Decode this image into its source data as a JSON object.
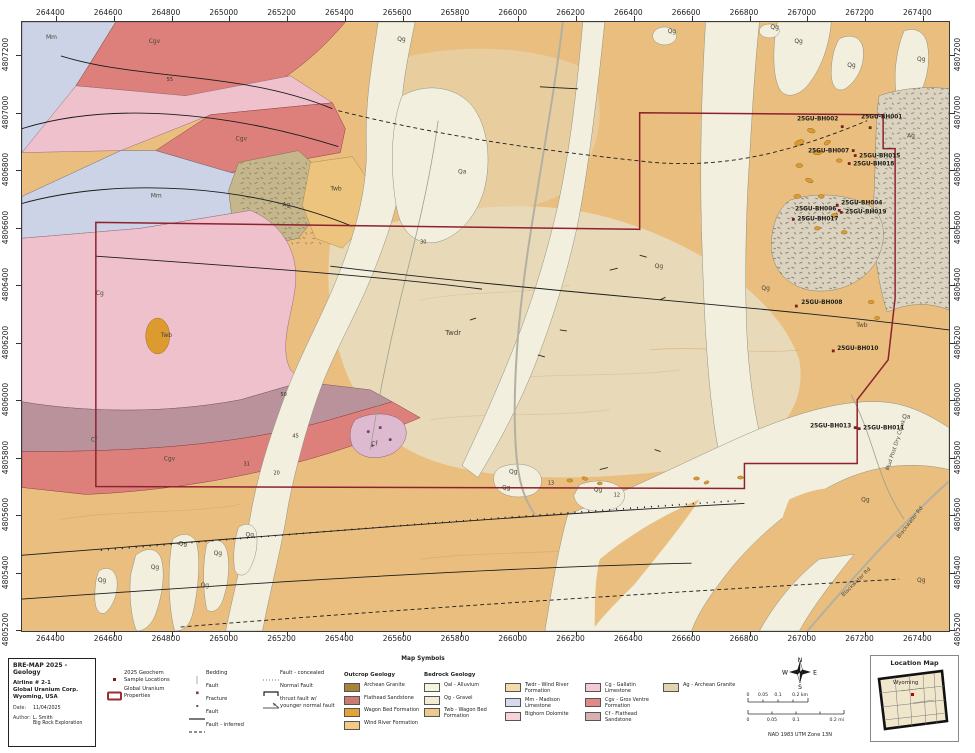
{
  "map": {
    "x_coords": [
      "264400",
      "264600",
      "264800",
      "265000",
      "265200",
      "265400",
      "265600",
      "265800",
      "266000",
      "266200",
      "266400",
      "266600",
      "266800",
      "267000",
      "267200",
      "267400"
    ],
    "y_coords": [
      "4807200",
      "4807000",
      "4806800",
      "4806600",
      "4806400",
      "4806200",
      "4806000",
      "4805800",
      "4805600",
      "4805400",
      "4805200"
    ],
    "unit_labels": [
      {
        "t": "Mm",
        "x": 45,
        "y": 38
      },
      {
        "t": "Cgv",
        "x": 148,
        "y": 42
      },
      {
        "t": "Cgv",
        "x": 235,
        "y": 140
      },
      {
        "t": "Mm",
        "x": 150,
        "y": 197
      },
      {
        "t": "Ag",
        "x": 282,
        "y": 206
      },
      {
        "t": "Twb",
        "x": 330,
        "y": 190
      },
      {
        "t": "Qa",
        "x": 458,
        "y": 173
      },
      {
        "t": "Qg",
        "x": 397,
        "y": 40
      },
      {
        "t": "Qg",
        "x": 668,
        "y": 32
      },
      {
        "t": "Qg",
        "x": 771,
        "y": 28
      },
      {
        "t": "Qg",
        "x": 795,
        "y": 42
      },
      {
        "t": "Qg",
        "x": 848,
        "y": 66
      },
      {
        "t": "Qg",
        "x": 918,
        "y": 60
      },
      {
        "t": "Ag",
        "x": 908,
        "y": 137
      },
      {
        "t": "Cg",
        "x": 95,
        "y": 295
      },
      {
        "t": "Twb",
        "x": 160,
        "y": 337
      },
      {
        "t": "Cf",
        "x": 90,
        "y": 442
      },
      {
        "t": "Cgv",
        "x": 163,
        "y": 461
      },
      {
        "t": "Twdr",
        "x": 445,
        "y": 335
      },
      {
        "t": "Cf",
        "x": 371,
        "y": 446
      },
      {
        "t": "Twb",
        "x": 857,
        "y": 327
      },
      {
        "t": "Qa",
        "x": 903,
        "y": 419
      },
      {
        "t": "Qg",
        "x": 655,
        "y": 268
      },
      {
        "t": "Qg",
        "x": 762,
        "y": 290
      },
      {
        "t": "Qg",
        "x": 509,
        "y": 474
      },
      {
        "t": "Qg",
        "x": 502,
        "y": 490
      },
      {
        "t": "Qg",
        "x": 594,
        "y": 492
      },
      {
        "t": "Qg",
        "x": 862,
        "y": 502
      },
      {
        "t": "Qg",
        "x": 918,
        "y": 583
      },
      {
        "t": "Qg",
        "x": 178,
        "y": 546
      },
      {
        "t": "Qg",
        "x": 213,
        "y": 556
      },
      {
        "t": "Qg",
        "x": 150,
        "y": 570
      },
      {
        "t": "Qg",
        "x": 200,
        "y": 588
      },
      {
        "t": "Qg",
        "x": 245,
        "y": 537
      },
      {
        "t": "Qg",
        "x": 97,
        "y": 583
      }
    ],
    "dip_labels": [
      {
        "t": "55",
        "x": 166,
        "y": 80
      },
      {
        "t": "30",
        "x": 420,
        "y": 243
      },
      {
        "t": "50",
        "x": 280,
        "y": 396
      },
      {
        "t": "45",
        "x": 292,
        "y": 438
      },
      {
        "t": "31",
        "x": 243,
        "y": 466
      },
      {
        "t": "20",
        "x": 273,
        "y": 475
      },
      {
        "t": "13",
        "x": 548,
        "y": 485
      },
      {
        "t": "12",
        "x": 614,
        "y": 497
      }
    ],
    "samples": [
      {
        "id": "25GU-BH002",
        "dx": 843,
        "dy": 126,
        "lx": 839,
        "ly": 120,
        "a": "end"
      },
      {
        "id": "25GU-BH001",
        "dx": 871,
        "dy": 127,
        "lx": 862,
        "ly": 118,
        "a": "start"
      },
      {
        "id": "25GU-BH007",
        "dx": 854,
        "dy": 150,
        "lx": 850,
        "ly": 152,
        "a": "end"
      },
      {
        "id": "25GU-BH015",
        "dx": 856,
        "dy": 155,
        "lx": 860,
        "ly": 157,
        "a": "start"
      },
      {
        "id": "25GU-BH018",
        "dx": 850,
        "dy": 163,
        "lx": 854,
        "ly": 165,
        "a": "start"
      },
      {
        "id": "25GU-BH006",
        "dx": 840,
        "dy": 210,
        "lx": 837,
        "ly": 210,
        "a": "end"
      },
      {
        "id": "25GU-BH004",
        "dx": 838,
        "dy": 205,
        "lx": 842,
        "ly": 204,
        "a": "start"
      },
      {
        "id": "25GU-BH019",
        "dx": 842,
        "dy": 212,
        "lx": 846,
        "ly": 213,
        "a": "start"
      },
      {
        "id": "25GU-BH017",
        "dx": 794,
        "dy": 219,
        "lx": 798,
        "ly": 220,
        "a": "start"
      },
      {
        "id": "25GU-BH008",
        "dx": 797,
        "dy": 306,
        "lx": 802,
        "ly": 304,
        "a": "start"
      },
      {
        "id": "25GU-BH010",
        "dx": 834,
        "dy": 351,
        "lx": 838,
        "ly": 350,
        "a": "start"
      },
      {
        "id": "25GU-BH013",
        "dx": 856,
        "dy": 428,
        "lx": 852,
        "ly": 428,
        "a": "end"
      },
      {
        "id": "25GU-BH011",
        "dx": 860,
        "dy": 429,
        "lx": 864,
        "ly": 430,
        "a": "start"
      }
    ],
    "path_labels": [
      {
        "t": "Blackwater Rd",
        "x": 912,
        "y": 524,
        "r": -52
      },
      {
        "t": "Blackwater Rd",
        "x": 858,
        "y": 584,
        "r": -45
      },
      {
        "t": "Mud Post Dry Creek",
        "x": 898,
        "y": 446,
        "r": -72
      }
    ]
  },
  "title_block": {
    "map_title": "BRE-MAP 2025 - Geology",
    "project": "Airline # 2-1",
    "company": "Global Uranium Corp.",
    "location": "Wyoming, USA",
    "date_label": "Date:",
    "date": "11/04/2025",
    "author_label": "Author:",
    "author": "L. Smith",
    "organization": "Big Rock Exploration"
  },
  "legend": {
    "columns": [
      {
        "x": 106,
        "items": [
          {
            "icon": "sample-dot",
            "lines": [
              "2025 Geochem",
              "Sample Locations"
            ]
          },
          {
            "icon": "property-rect",
            "lines": [
              "Global Uranium",
              "Properties"
            ]
          }
        ]
      },
      {
        "x": 188,
        "items": [
          {
            "icon": "bedding",
            "lines": [
              "Bedding"
            ]
          },
          {
            "icon": "fault-dot",
            "lines": [
              "Fault"
            ]
          },
          {
            "icon": "fracture-dot",
            "lines": [
              "Fracture"
            ]
          },
          {
            "icon": "fault-line",
            "lines": [
              "Fault"
            ]
          },
          {
            "icon": "fault-inferred",
            "lines": [
              "Fault - inferred"
            ]
          }
        ]
      },
      {
        "x": 262,
        "items": [
          {
            "icon": "fault-concealed",
            "lines": [
              "Fault - concealed"
            ]
          },
          {
            "icon": "normal-fault",
            "lines": [
              "Normal Fault"
            ]
          },
          {
            "icon": "thrust-fault",
            "lines": [
              "thrust fault w/",
              "younger normal fault"
            ]
          }
        ]
      }
    ],
    "map_symbols_title": "Map Symbols",
    "geo_columns": [
      {
        "x": 344,
        "header": "Outcrop Geology",
        "items": [
          {
            "color": "#a9833b",
            "lines": [
              "Archean Granite"
            ]
          },
          {
            "color": "#cd7a70",
            "lines": [
              "Flathead Sandstone"
            ]
          },
          {
            "color": "#e3a33b",
            "lines": [
              "Wagon Bed Formation"
            ]
          },
          {
            "color": "#f4ca81",
            "lines": [
              "Wind River Formation"
            ]
          }
        ]
      },
      {
        "x": 424,
        "header": "Bedrock Geology",
        "items": [
          {
            "color": "#f7f3dc",
            "lines": [
              "Qal - Alluvium"
            ]
          },
          {
            "color": "#f3ecd0",
            "lines": [
              "Qg - Gravel"
            ]
          },
          {
            "color": "#eec98d",
            "lines": [
              "Twb - Wagon Bed",
              "Formation"
            ]
          }
        ]
      },
      {
        "x": 505,
        "header": "",
        "items": [
          {
            "color": "#f2dcab",
            "lines": [
              "Twdr - Wind River",
              "Formation"
            ]
          },
          {
            "color": "#d6daee",
            "lines": [
              "Mm - Madison",
              "Limestone"
            ]
          },
          {
            "color": "#f5d3d9",
            "lines": [
              "Bighorn Dolomite"
            ]
          }
        ]
      },
      {
        "x": 585,
        "header": "",
        "items": [
          {
            "color": "#f5cad5",
            "lines": [
              "Cg - Gallatin",
              "Limestone"
            ]
          },
          {
            "color": "#e08a87",
            "lines": [
              "Cgv - Gros Ventre",
              "Formation"
            ]
          },
          {
            "color": "#d9b0b2",
            "lines": [
              "Cf - Flathead",
              "Sandstone"
            ]
          }
        ]
      },
      {
        "x": 663,
        "header": "",
        "items": [
          {
            "color": "#e0d5ad",
            "lines": [
              "Ag - Archean Granite"
            ]
          }
        ]
      }
    ]
  },
  "compass": {
    "n": "N",
    "e": "E",
    "s": "S",
    "w": "W"
  },
  "scalebar": {
    "km_labels": [
      "0",
      "0.05",
      "0.1",
      "0.2 km"
    ],
    "mi_labels": [
      "0",
      "0.05",
      "0.1",
      "0.2 mi"
    ],
    "datum": "NAD 1983 UTM Zone 13N"
  },
  "location_map": {
    "title": "Location Map",
    "state": "Wyoming"
  },
  "colors": {
    "property_boundary": "#8e2130",
    "sample_marker": "#7a1f1f"
  }
}
